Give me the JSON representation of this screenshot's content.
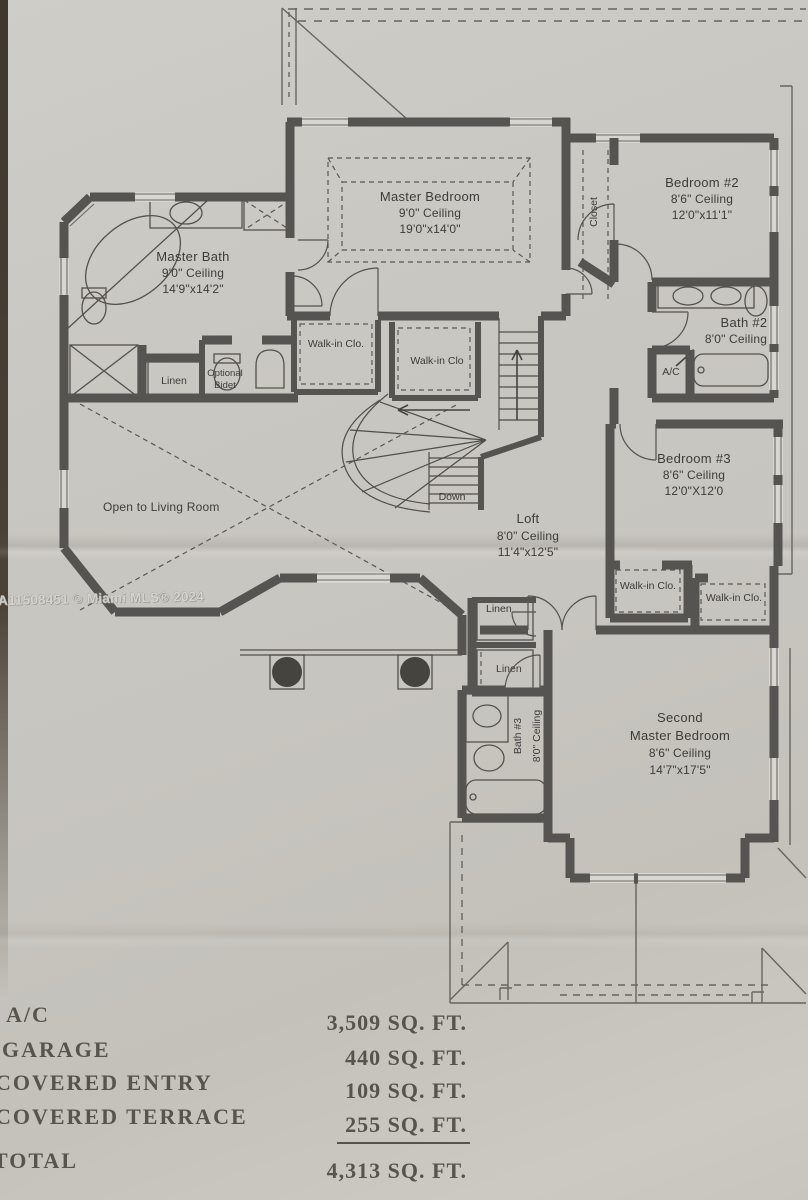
{
  "watermark": {
    "text": "A11508451 © Miami MLS® 2024"
  },
  "rooms": {
    "master_bedroom": {
      "name": "Master Bedroom",
      "ceiling": "9'0\" Ceiling",
      "dims": "19'0\"x14'0\""
    },
    "bedroom2": {
      "name": "Bedroom #2",
      "ceiling": "8'6\" Ceiling",
      "dims": "12'0\"x11'1\""
    },
    "master_bath": {
      "name": "Master Bath",
      "ceiling": "9'0\" Ceiling",
      "dims": "14'9\"x14'2\""
    },
    "bath2": {
      "name": "Bath #2",
      "ceiling": "8'0\" Ceiling"
    },
    "bedroom3": {
      "name": "Bedroom #3",
      "ceiling": "8'6\" Ceiling",
      "dims": "12'0\"X12'0"
    },
    "loft": {
      "name": "Loft",
      "ceiling": "8'0\" Ceiling",
      "dims": "11'4\"x12'5\""
    },
    "bath3": {
      "name": "Bath #3",
      "ceiling": "8'0\" Ceiling"
    },
    "second_master": {
      "line1": "Second",
      "line2": "Master Bedroom",
      "ceiling": "8'6\" Ceiling",
      "dims": "14'7\"x17'5\""
    }
  },
  "labels": {
    "closet": "Closet",
    "wic_dot": "Walk-in Clo.",
    "wic": "Walk-in Clo",
    "linen": "Linen",
    "optional": "Optional",
    "bidet": "Bidet",
    "ac": "A/C",
    "down": "Down",
    "open_living": "Open to Living Room"
  },
  "area_table": {
    "rows": [
      {
        "label": "A/C",
        "value": "3,509 SQ. FT."
      },
      {
        "label": "GARAGE",
        "value": "440 SQ. FT."
      },
      {
        "label": "COVERED ENTRY",
        "value": "109 SQ. FT."
      },
      {
        "label": "COVERED TERRACE",
        "value": "255 SQ. FT."
      }
    ],
    "total": {
      "label": "TOTAL",
      "value": "4,313 SQ. FT."
    }
  },
  "colors": {
    "paper": "#c9c7c1",
    "wall": "#565450",
    "line": "#504e4a",
    "text": "#3d3c3a",
    "table_text": "#56544b",
    "edge": "#4b4237"
  }
}
